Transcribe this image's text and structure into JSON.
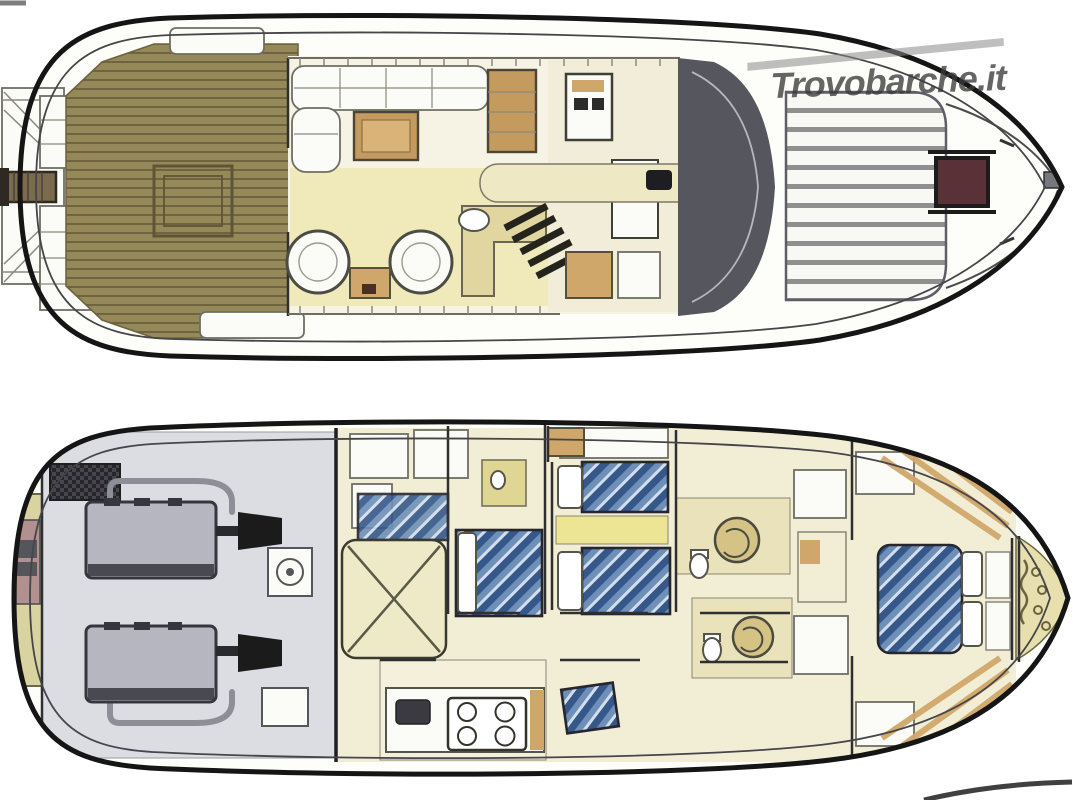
{
  "watermark": {
    "text": "Trovobarche.it"
  },
  "colors": {
    "hull_line": "#151515",
    "teak": "#95895a",
    "teak_plank": "#6e6540",
    "cream": "#f2eed6",
    "pale_yellow": "#f0e9ba",
    "tan": "#cfa76a",
    "cabinet_wood": "#c49a5e",
    "windshield_gray": "#55565e",
    "hatch_maroon": "#5a3136",
    "sunpad_stripe": "#8f8f8f",
    "engine_floor": "#dcdce3",
    "engine_gray": "#b5b6c0",
    "engine_dark": "#36363e",
    "generator": "#46464c",
    "gearbox": "#1b1b1b",
    "bed_blue": "#6d8fb8",
    "bed_blue_dark": "#35578a",
    "bed_blue_light": "#d3deec",
    "shower_tan": "#d5c386",
    "locker_yellow": "#e7e0ae",
    "accent_yellow": "#ece594",
    "mauve": "#b29090",
    "wall": "#2f2f2f",
    "watermark": "#3b3b3b"
  }
}
